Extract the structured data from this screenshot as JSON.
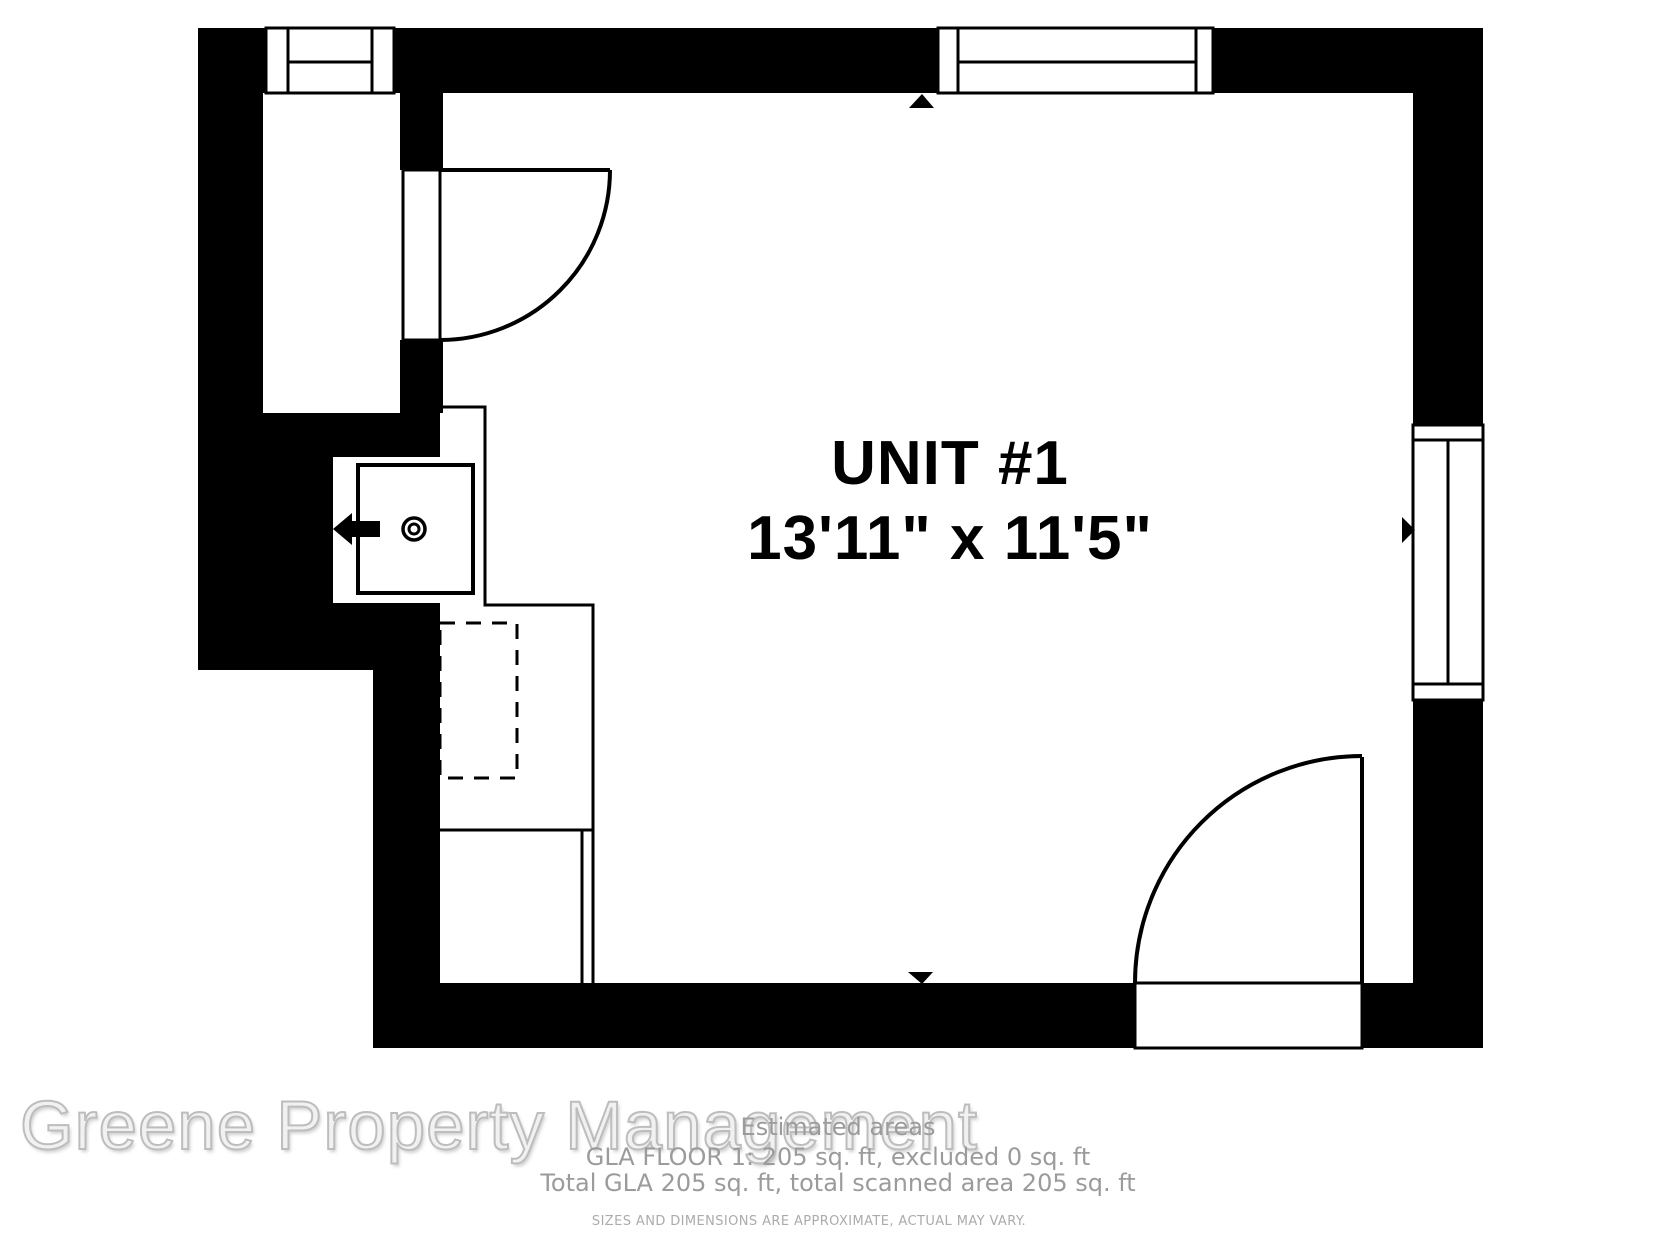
{
  "floorplan": {
    "unit_label": "UNIT #1",
    "dimensions_label": "13'11\" x 11'5\"",
    "colors": {
      "wall": "#000000",
      "floor": "#ffffff",
      "line": "#000000",
      "footer_text": "#9b9b9b",
      "disclaimer_text": "#ababab",
      "watermark_fill": "#f1f1f1",
      "watermark_stroke": "#bdbdbd"
    },
    "icons": {
      "scan-marker-up": "▲",
      "scan-marker-down": "▼",
      "scan-marker-right": "▶",
      "faucet-arrow": "◀",
      "drain-circle": "◎"
    }
  },
  "footer": {
    "title": "Estimated areas",
    "line1": "GLA FLOOR 1: 205 sq. ft, excluded 0 sq. ft",
    "line2": "Total GLA 205 sq. ft, total scanned area 205 sq. ft",
    "disclaimer": "SIZES AND DIMENSIONS ARE APPROXIMATE, ACTUAL MAY VARY."
  },
  "watermark": {
    "text": "Greene Property Management"
  }
}
